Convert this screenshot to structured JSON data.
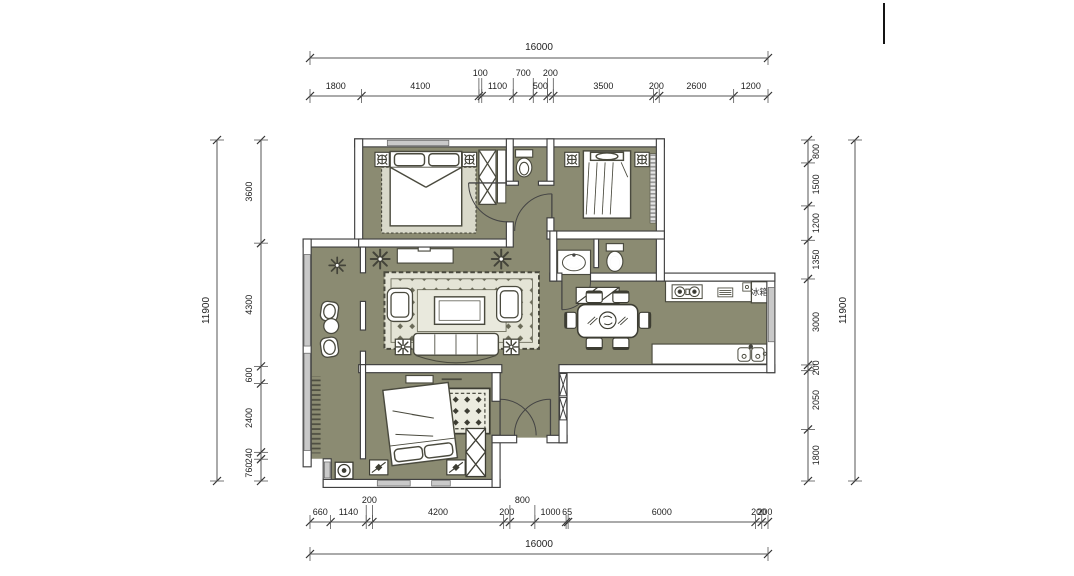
{
  "drawing": {
    "type": "residential floor plan",
    "fridge_label": "冰箱",
    "colors": {
      "floor": "#8b8b72",
      "rug": "#e4e4d6",
      "wall_outline": "#3f3f3f",
      "window_fill": "#c9c9c9",
      "dim_line": "#555555",
      "dim_text": "#222222"
    }
  },
  "dimensions": {
    "top": {
      "overall": "16000",
      "segments": [
        {
          "v": "1800"
        },
        {
          "v": "4100"
        },
        {
          "v": "100",
          "up": true
        },
        {
          "v": "1100"
        },
        {
          "v": "700",
          "up": true
        },
        {
          "v": "500"
        },
        {
          "v": "200",
          "up": true
        },
        {
          "v": "3500"
        },
        {
          "v": "200"
        },
        {
          "v": "2600"
        },
        {
          "v": "1200"
        }
      ]
    },
    "bottom": {
      "overall": "16000",
      "segments": [
        {
          "v": "660"
        },
        {
          "v": "1140"
        },
        {
          "v": "200",
          "up": true
        },
        {
          "v": "4200"
        },
        {
          "v": "200"
        },
        {
          "v": "800",
          "up": true
        },
        {
          "v": "1000"
        },
        {
          "v": "65"
        },
        {
          "v": "6000"
        },
        {
          "v": "200"
        },
        {
          "v": "200"
        }
      ]
    },
    "left": {
      "overall": "11900",
      "segments": [
        {
          "v": "3600"
        },
        {
          "v": "4300"
        },
        {
          "v": "600"
        },
        {
          "v": "2400"
        },
        {
          "v": "240"
        },
        {
          "v": "760"
        }
      ]
    },
    "right": {
      "overall": "11900",
      "segments": [
        {
          "v": "800"
        },
        {
          "v": "1500"
        },
        {
          "v": "1200"
        },
        {
          "v": "1350"
        },
        {
          "v": "3000"
        },
        {
          "v": "200"
        },
        {
          "v": "2050"
        },
        {
          "v": "1800"
        }
      ]
    }
  }
}
